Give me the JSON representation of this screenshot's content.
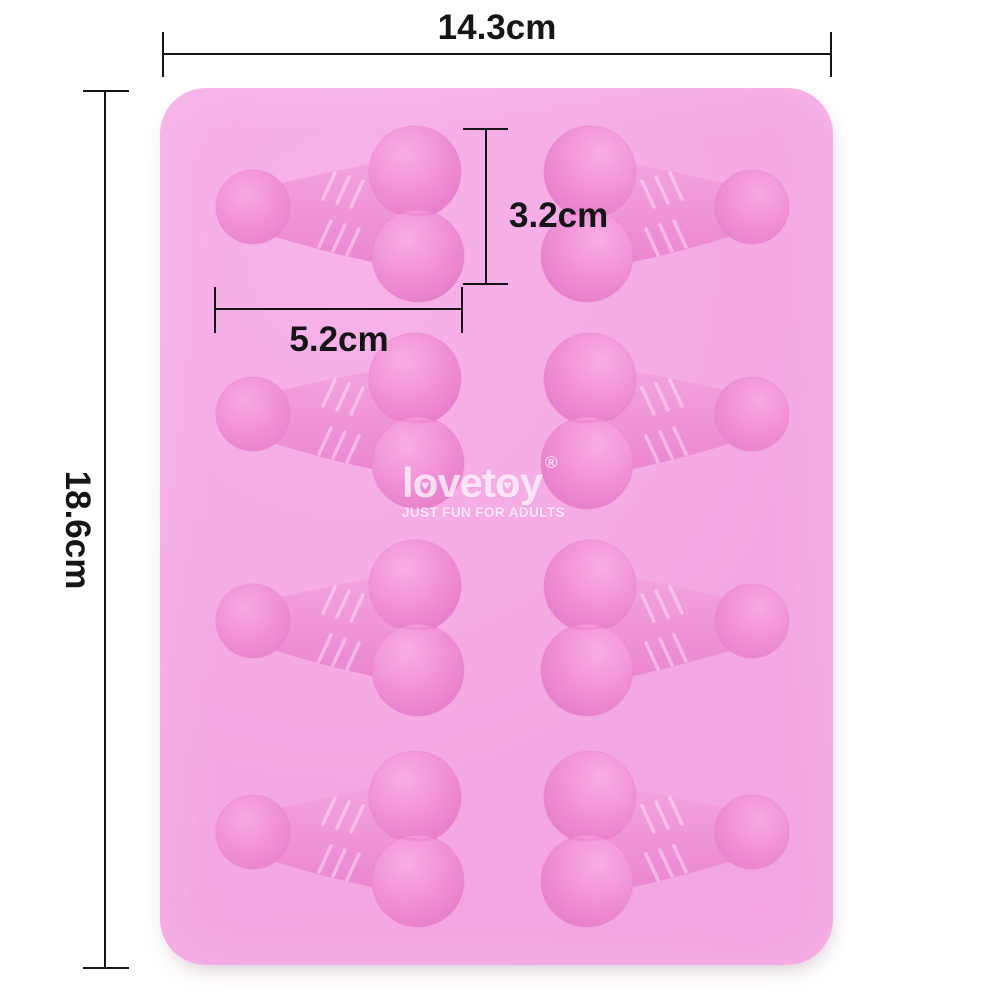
{
  "dimensions": {
    "overall_width": "14.3cm",
    "overall_height": "18.6cm",
    "cavity_height": "3.2cm",
    "cavity_width": "5.2cm"
  },
  "logo": {
    "name": "lovetoy",
    "part_l": "l",
    "part_o1": "o",
    "part_vet": "vet",
    "part_o2": "o",
    "part_y": "y",
    "heart_icon": "♥",
    "registered_mark": "®",
    "tagline": "JUST FUN FOR ADULTS"
  },
  "mold": {
    "cavity_rows": 4,
    "cavity_columns": 2,
    "cavity_total": 8
  },
  "colors": {
    "background": "#ffffff",
    "mold_base": "#f5aae4",
    "cavity_mid": "#f193d9",
    "cavity_shadow": "#e77ec9",
    "cavity_highlight": "#f9ade4",
    "dimension_line": "#151515",
    "logo_text": "rgba(255,255,255,0.72)"
  }
}
